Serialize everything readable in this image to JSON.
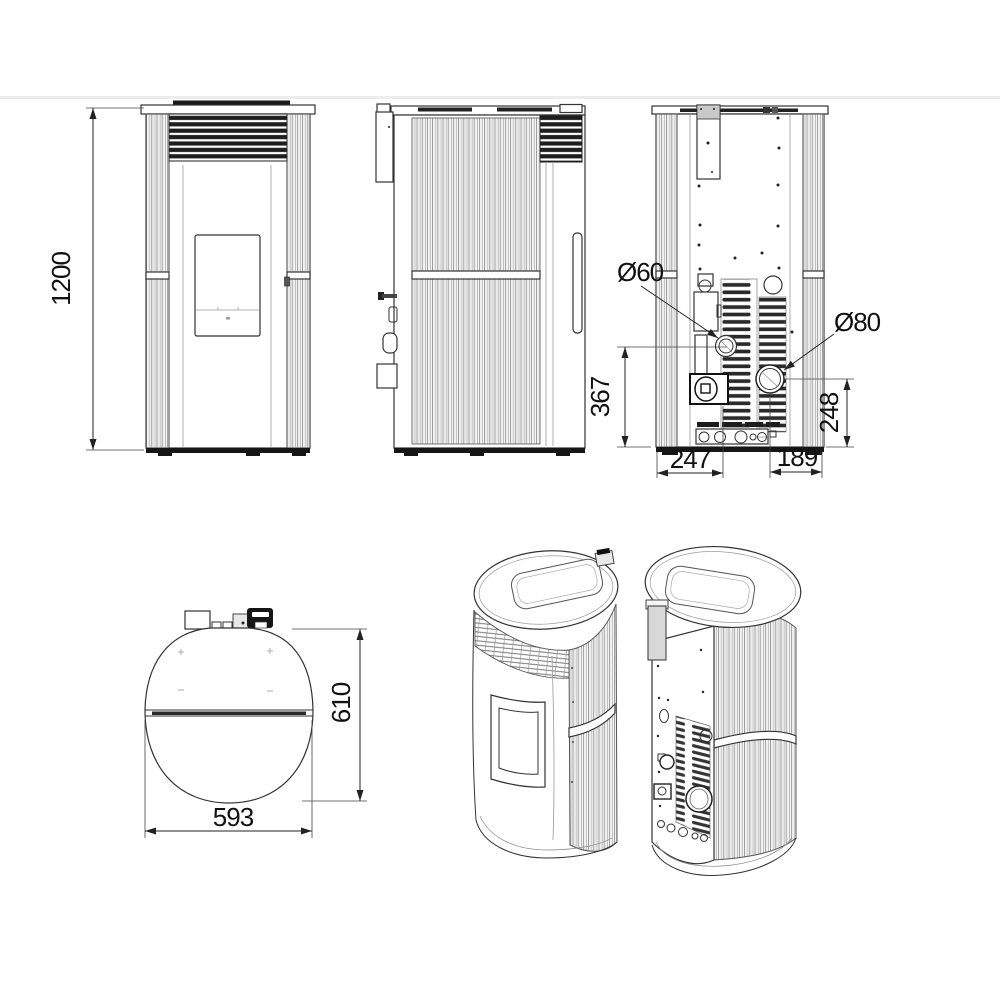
{
  "drawing": {
    "type": "pellet-stove dimensional technical drawing",
    "colors": {
      "background": "#ffffff",
      "line": "#2b2b2b",
      "dark_fill": "#1c1c1c"
    },
    "dims": {
      "height": "1200",
      "intake_diameter": "Ø60",
      "flue_diameter": "Ø80",
      "intake_center_height": "367",
      "flue_center_height": "248",
      "intake_center_offset": "247",
      "flue_center_offset": "189",
      "depth": "610",
      "width": "593"
    }
  }
}
